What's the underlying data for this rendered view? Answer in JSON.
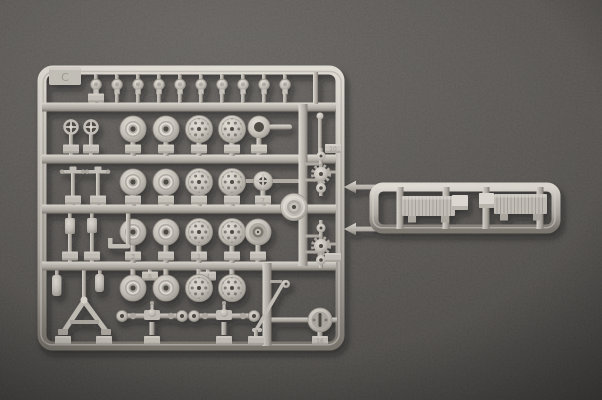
{
  "scene": {
    "type": "photograph",
    "subject": "plastic model-kit sprue (injection-moulded parts tree)",
    "description": "Light grey styrene sprue photographed from above on a dark speckled grey surface. The square runner frame holds four rows of road wheels (solid-hub and perforated types), a top row of small hub caps, hand wheels, levers, shock absorbers, a tow-bar A-frame, two axle assemblies, gear shafts, a cable drum and a turntable disc. A ladder-shaped runner extension on the right carries two ribbed fender panels."
  },
  "colors": {
    "bg_hi": "#5b5754",
    "bg": "#4b4744",
    "bg_dk": "#393633",
    "plastic_hi": "#e6e2da",
    "plastic": "#cac6be",
    "plastic_mid": "#b2ada5",
    "plastic_sh": "#9b968e",
    "plastic_dk": "#7e7971",
    "hole": "#4a4641",
    "shadow": "#14110f"
  },
  "markings": {
    "tab_letter": "C",
    "tags": [
      "3",
      "1",
      "6",
      "4",
      "7",
      "10",
      "16"
    ]
  },
  "inventory": {
    "hub_caps_top_row": 10,
    "road_wheels_solid_hub": 8,
    "road_wheels_perforated": 8,
    "hand_wheels": 2,
    "lever_parts": 2,
    "canister_parts": 2,
    "shock_absorbers": 2,
    "tow_bar_a_frame": 1,
    "axle_assemblies": 2,
    "linkage_rod": 1,
    "cable_drum": 1,
    "gear_shaft_assemblies": 2,
    "idler_ring": 1,
    "cross_hub_ring": 1,
    "deep_dish_wheel": 1,
    "turntable_disc": 1,
    "ribbed_fenders": 2
  }
}
